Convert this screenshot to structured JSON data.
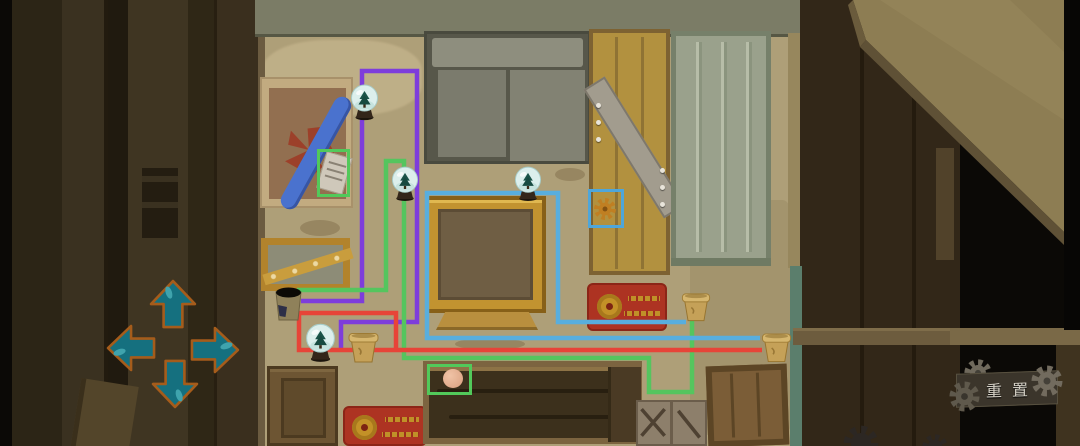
{
  "scene": {
    "name": "attic-room-wire-puzzle",
    "description": "point-and-click room with colored wires connecting snow globes and pots"
  },
  "ui": {
    "reset_label": "重置",
    "reset_colors": {
      "plaque": "#3b352b",
      "text": "#d5d1c6",
      "gear": "#6f695c"
    },
    "dpad": {
      "fill": "#15707f",
      "outline": "#a55c1b",
      "buttons": [
        "up",
        "left",
        "right",
        "down"
      ]
    }
  },
  "icons": {
    "dpad_up": "arrow-up-icon",
    "dpad_down": "arrow-down-icon",
    "dpad_left": "arrow-left-icon",
    "dpad_right": "arrow-right-icon",
    "reset": "gear-icon",
    "door_item": "gear-icon",
    "globes": "snow-globe-icon",
    "pots": "flower-pot-icon"
  },
  "wires": [
    {
      "name": "purple-wire",
      "color": "#7e3ddb",
      "paths": [
        [
          [
            301,
            301
          ],
          [
            362,
            301
          ],
          [
            362,
            71
          ],
          [
            417,
            71
          ],
          [
            417,
            322
          ],
          [
            341,
            322
          ],
          [
            341,
            351
          ]
        ]
      ]
    },
    {
      "name": "green-wire",
      "color": "#55c55e",
      "paths": [
        [
          [
            297,
            290
          ],
          [
            386,
            290
          ],
          [
            386,
            161
          ],
          [
            404,
            161
          ],
          [
            404,
            358
          ],
          [
            649,
            358
          ],
          [
            649,
            392
          ],
          [
            692,
            392
          ],
          [
            692,
            320
          ]
        ]
      ]
    },
    {
      "name": "red-wire",
      "color": "#e74438",
      "paths": [
        [
          [
            762,
            350
          ],
          [
            299,
            350
          ],
          [
            299,
            313
          ],
          [
            396,
            313
          ],
          [
            396,
            350
          ]
        ]
      ]
    },
    {
      "name": "blue-wire",
      "color": "#58aede",
      "paths": [
        [
          [
            686,
            322
          ],
          [
            558,
            322
          ],
          [
            558,
            193
          ],
          [
            427,
            193
          ],
          [
            427,
            338
          ],
          [
            760,
            338
          ]
        ]
      ]
    }
  ],
  "highlights": [
    {
      "name": "note-highlight-box",
      "color": "#52c95a",
      "x": 317,
      "y": 149,
      "w": 33,
      "h": 48
    },
    {
      "name": "gear-highlight-box",
      "color": "#4ea6da",
      "x": 588,
      "y": 189,
      "w": 36,
      "h": 39
    },
    {
      "name": "peach-highlight-box",
      "color": "#52c95a",
      "x": 427,
      "y": 364,
      "w": 45,
      "h": 31
    }
  ],
  "snow_globes": [
    {
      "name": "snow-globe-top-left",
      "x": 350,
      "y": 84,
      "w": 29,
      "h": 37
    },
    {
      "name": "snow-globe-mid-left",
      "x": 391,
      "y": 166,
      "w": 28,
      "h": 36
    },
    {
      "name": "snow-globe-shelf",
      "x": 514,
      "y": 166,
      "w": 28,
      "h": 36
    },
    {
      "name": "snow-globe-bottom-left",
      "x": 305,
      "y": 323,
      "w": 31,
      "h": 40
    }
  ],
  "pots": [
    {
      "name": "dark-pot",
      "type": "dark",
      "x": 273,
      "y": 283,
      "w": 31,
      "h": 41
    },
    {
      "name": "tan-pot-left",
      "type": "tan",
      "x": 347,
      "y": 331,
      "w": 33,
      "h": 33
    },
    {
      "name": "tan-pot-right-upper",
      "type": "tan",
      "x": 681,
      "y": 291,
      "w": 30,
      "h": 32
    },
    {
      "name": "tan-pot-right-lower",
      "type": "tan",
      "x": 761,
      "y": 330,
      "w": 31,
      "h": 35
    }
  ]
}
